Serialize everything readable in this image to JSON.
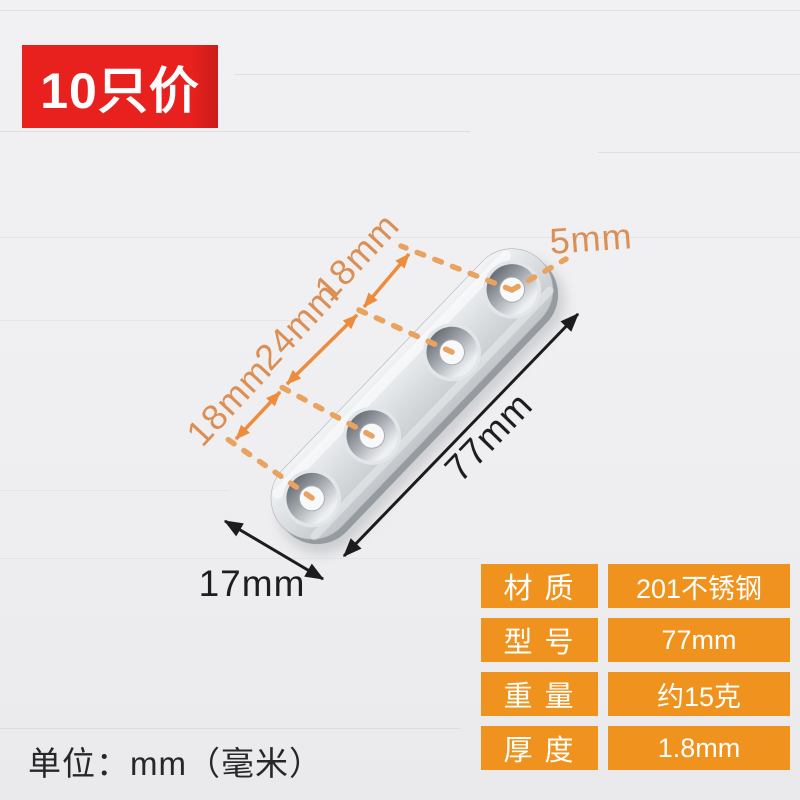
{
  "badge": {
    "label": "10只价"
  },
  "annotations": {
    "hole_diameter": "5mm",
    "hole_spacing_bottom": "18mm",
    "hole_spacing_middle": "24mm",
    "hole_spacing_top": "18mm",
    "plate_length": "77mm",
    "plate_width": "17mm"
  },
  "unit_note": "单位：mm（毫米）",
  "spec_table": {
    "rows": [
      {
        "label": "材 质",
        "value": "201不锈钢"
      },
      {
        "label": "型 号",
        "value": "77mm"
      },
      {
        "label": "重 量",
        "value": "约15克"
      },
      {
        "label": "厚 度",
        "value": "1.8mm"
      }
    ]
  },
  "colors": {
    "badge_red": "#E9211E",
    "table_orange": "#F0921E",
    "annotation_arrow_orange": "#ED8C3C",
    "annotation_dot_orange": "#E9A25F",
    "plate_silver": "#D6D9DC",
    "background": "#EFEFF1"
  }
}
